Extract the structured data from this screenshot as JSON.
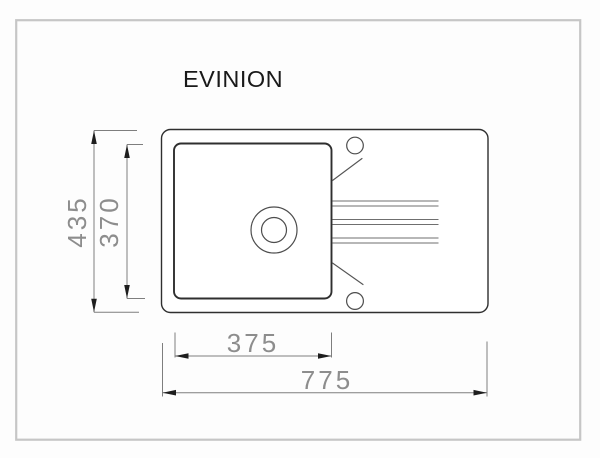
{
  "page": {
    "background": "#fdfdfd",
    "border_color": "#c6c6c6"
  },
  "drawing": {
    "title": "EVINION",
    "view": "sink top view technical drawing",
    "dimensions": {
      "overall_depth_mm": "435",
      "bowl_depth_mm": "370",
      "bowl_width_mm": "375",
      "overall_width_mm": "775"
    }
  }
}
